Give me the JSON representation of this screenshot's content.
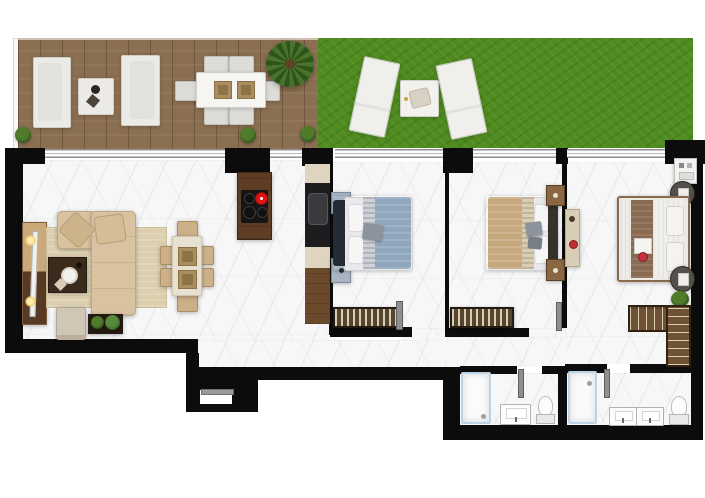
{
  "meta": {
    "view": "apartment floor plan, top-down 3D render",
    "bedrooms": 3,
    "bathrooms": 2,
    "outdoor_zones": [
      "wood-deck-terrace",
      "garden-lawn"
    ]
  },
  "palette": {
    "wall": "#0c0c0c",
    "marble": "#f7f7f8",
    "deck_wood": "#8b6f52",
    "lawn": "#4f8b1e",
    "rug": "#dbcfae",
    "sofa_beige": "#d8c2a0",
    "wood_dark": "#5e3d24",
    "cream": "#ded4c0",
    "appliance_black": "#1d1d1f",
    "bed_blue": "#8fa6bd",
    "bed_tan": "#c6a87e",
    "bed_white": "#efeeeb",
    "headboard_dark": "#242c38",
    "burner_red": "#e01414",
    "shower_border": "#bcd3e6",
    "door_gray": "#8f8f8f",
    "plant_green": "#3f6b22"
  },
  "inventory": {
    "terrace": [
      "outdoor-sofa",
      "outdoor-sofa",
      "outdoor-coffee-table",
      "outdoor-dining-table",
      "outdoor-dining-chair x6",
      "potted-palm",
      "shrub x3",
      "sun-lounger x2",
      "lounger-side-table"
    ],
    "living_room": [
      "tv-console",
      "tv",
      "table-lamp x2",
      "rug",
      "sectional-sofa",
      "coffee-table",
      "armchair",
      "plant-stand",
      "dining-table",
      "dining-chair x6"
    ],
    "kitchen": [
      "island-with-cooktop",
      "counter-run",
      "sink",
      "oven-column"
    ],
    "bedroom_1": [
      "double-bed-blue",
      "nightstand x2",
      "radiator"
    ],
    "bedroom_2": [
      "double-bed-tan",
      "nightstand x2",
      "radiator"
    ],
    "bedroom_3": [
      "double-bed-white",
      "round-nightstand x2",
      "desk",
      "ac-unit",
      "l-shaped-wardrobe",
      "plant"
    ],
    "bathroom_1": [
      "shower",
      "vanity-sink",
      "toilet"
    ],
    "bathroom_2": [
      "shower",
      "double-vanity",
      "toilet"
    ]
  }
}
